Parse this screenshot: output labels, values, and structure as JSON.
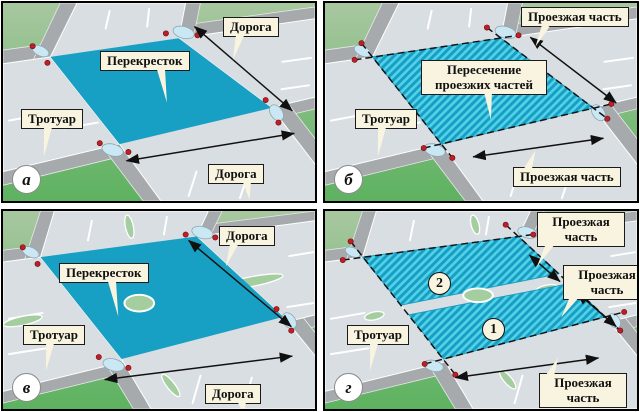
{
  "colors": {
    "intersection_cyan": "#17A0C3",
    "hatch_light": "#52D3E8",
    "hatch_dark": "#189EC4",
    "label_background": "#F8F4DF",
    "marker_red": "#C01E26",
    "grass_far": "#A8C7A0",
    "grass_near": "#5DB260",
    "road_gray": "#D9DEE3",
    "sidewalk_gray": "#A7AAAD",
    "median_green": "#A5CEA0"
  },
  "panels": {
    "a": {
      "letter": "а",
      "labels": {
        "intersection": "Перекресток",
        "sidewalk": "Тротуар",
        "road_top": "Дорога",
        "road_bottom": "Дорога"
      }
    },
    "b": {
      "letter": "б",
      "labels": {
        "intersection": "Пересечение проезжих частей",
        "sidewalk": "Тротуар",
        "carriageway_top": "Проезжая часть",
        "carriageway_bottom": "Проезжая часть"
      }
    },
    "v": {
      "letter": "в",
      "labels": {
        "intersection": "Перекресток",
        "sidewalk": "Тротуар",
        "road_top": "Дорога",
        "road_bottom": "Дорога"
      }
    },
    "g": {
      "letter": "г",
      "labels": {
        "sidewalk": "Тротуар",
        "carriageway_top": "Проезжая часть",
        "carriageway_right": "Проезжая часть",
        "carriageway_bottom": "Проезжая часть"
      },
      "markers": {
        "area1": "1",
        "area2": "2"
      }
    }
  }
}
